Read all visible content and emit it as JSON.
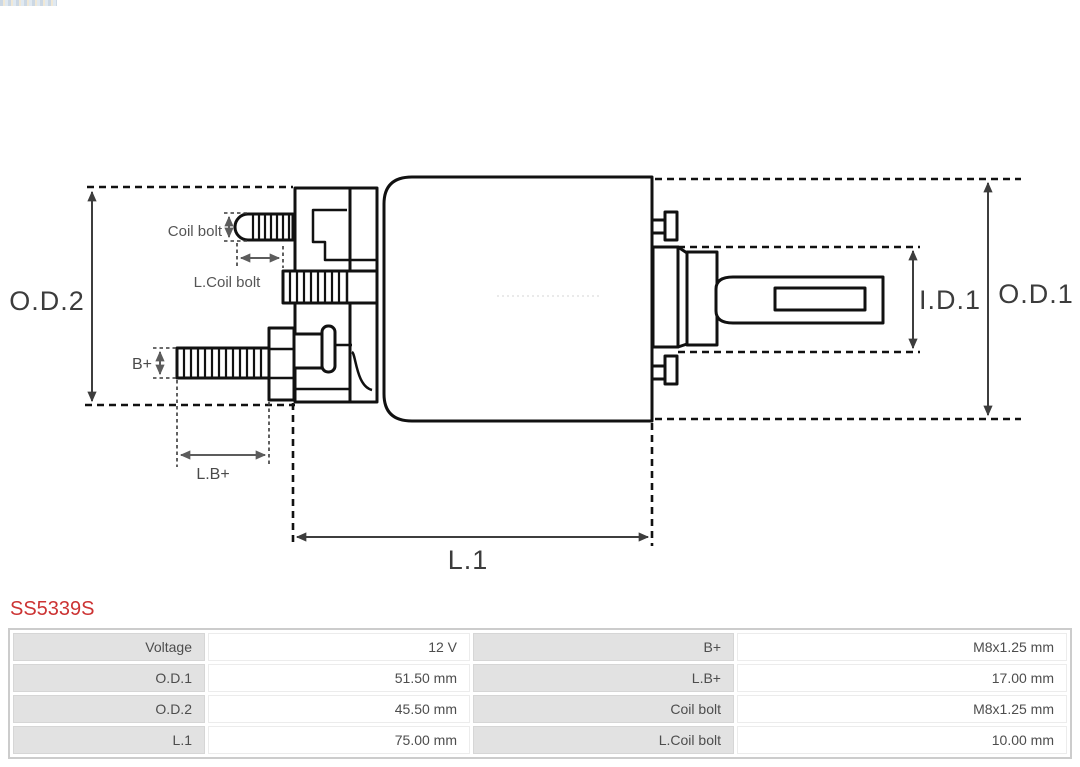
{
  "product": {
    "part_number": "SS5339S"
  },
  "colors": {
    "part_number_red": "#cc3333",
    "diagram_line": "#111111",
    "table_label_bg": "#e2e2e2",
    "table_text": "#4d4d4d",
    "table_border": "#cccccc"
  },
  "icons": {
    "logo_strip": "partial-logo-strip",
    "dimension_arrows": "double-headed-arrow"
  },
  "diagram": {
    "labels": {
      "od2": "O.D.2",
      "od1": "O.D.1",
      "id1": "I.D.1",
      "l1": "L.1",
      "b_plus": "B+",
      "lb_plus": "L.B+",
      "coil_bolt": "Coil bolt",
      "l_coil_bolt": "L.Coil bolt"
    }
  },
  "spec_table": {
    "rows": [
      {
        "label_left": "Voltage",
        "value_left": "12 V",
        "label_right": "B+",
        "value_right": "M8x1.25 mm"
      },
      {
        "label_left": "O.D.1",
        "value_left": "51.50 mm",
        "label_right": "L.B+",
        "value_right": "17.00 mm"
      },
      {
        "label_left": "O.D.2",
        "value_left": "45.50 mm",
        "label_right": "Coil bolt",
        "value_right": "M8x1.25 mm"
      },
      {
        "label_left": "L.1",
        "value_left": "75.00 mm",
        "label_right": "L.Coil bolt",
        "value_right": "10.00 mm"
      }
    ]
  }
}
